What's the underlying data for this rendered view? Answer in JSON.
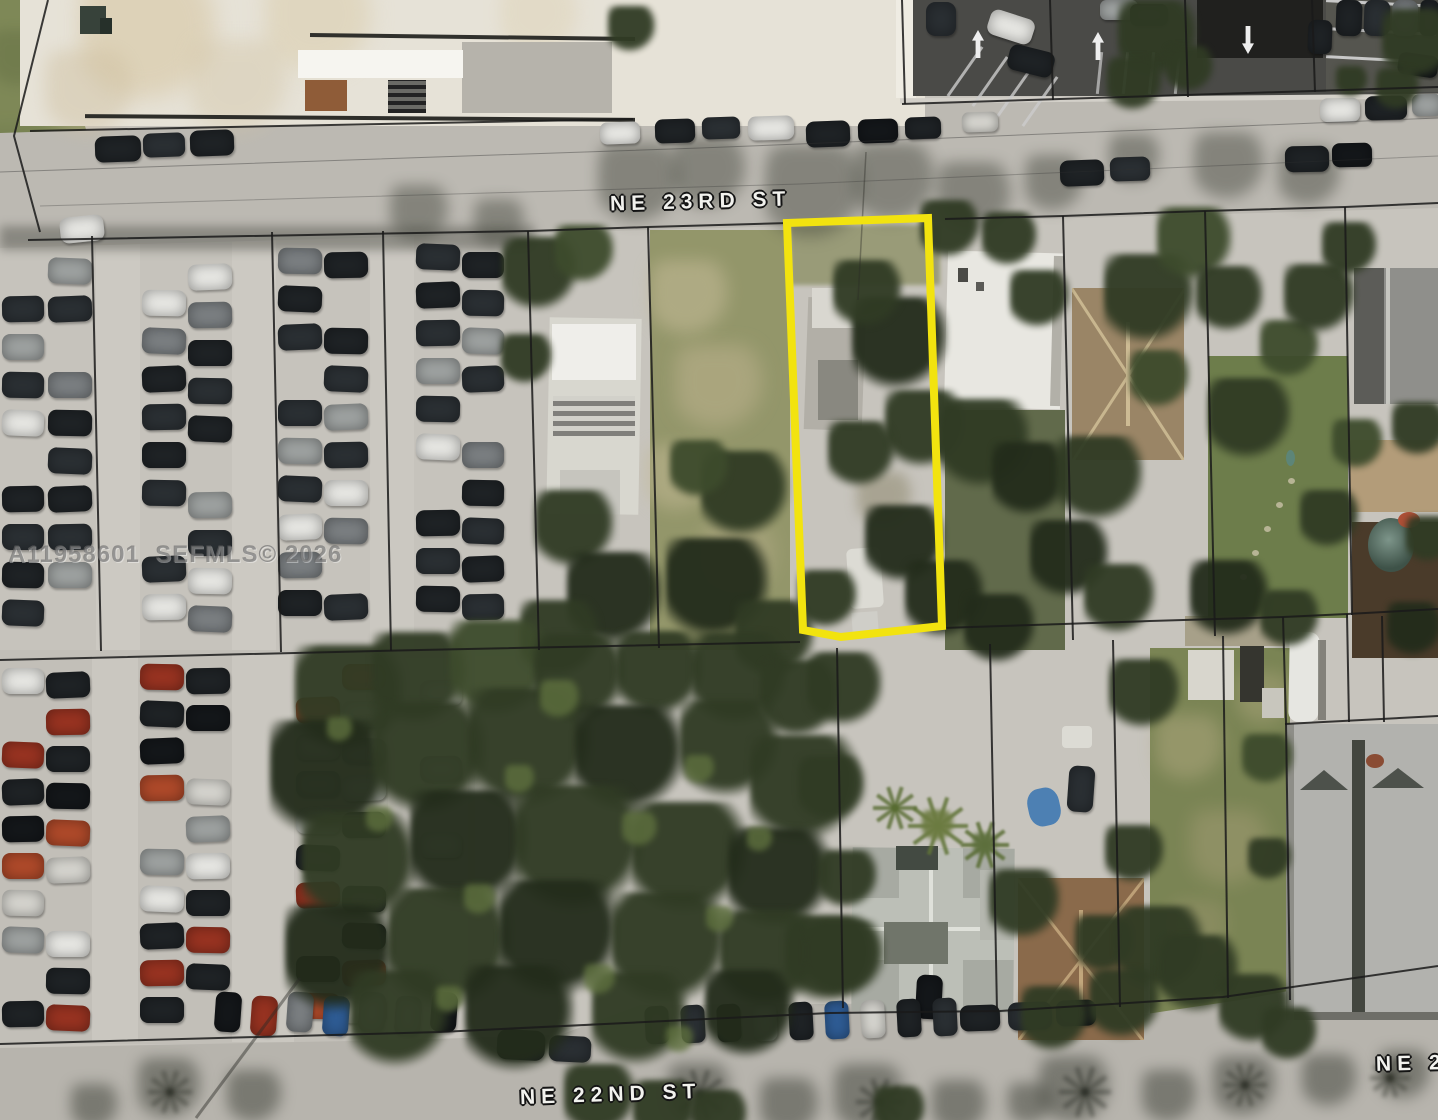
{
  "map": {
    "type": "aerial-photo",
    "streets": [
      {
        "id": "ne-23rd-st",
        "label": "NE 23RD ST"
      },
      {
        "id": "ne-22nd-st",
        "label": "NE 22ND ST"
      },
      {
        "id": "ne-2-partial",
        "label": "NE 2"
      }
    ],
    "watermark": "A11958601  SEFMLS© 2026",
    "highlight_color": "#f2e30f",
    "parcel_line_color": "#1a1a1a"
  }
}
